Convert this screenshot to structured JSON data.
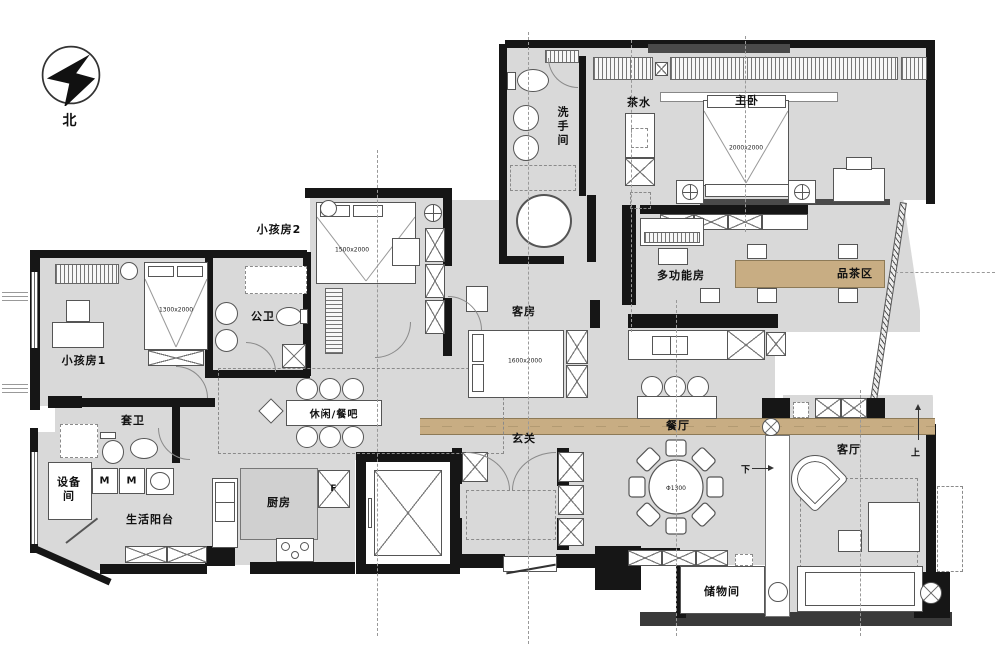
{
  "compass": {
    "north": "北"
  },
  "rooms": {
    "washroom": "洗手间",
    "tea": "茶水",
    "master": "主卧",
    "multi": "多功能房",
    "tea_area": "品茶区",
    "kids2": "小孩房2",
    "kids1": "小孩房1",
    "public_bath": "公卫",
    "guest": "客房",
    "bar": "休闲/餐吧",
    "ensuite": "套卫",
    "equipment": "设备间",
    "balcony": "生活阳台",
    "kitchen": "厨房",
    "entry": "玄关",
    "dining": "餐厅",
    "living": "客厅",
    "storage": "储物间"
  },
  "dims": {
    "master_bed": "2000x2000",
    "kids2_bed": "1500x2000",
    "kids1_bed": "1300x2000",
    "guest_bed": "1600x2000",
    "dining_table": "Φ1300"
  },
  "ann": {
    "up": "上",
    "down": "下",
    "fridge": "F",
    "washer": "M"
  },
  "colors": {
    "room_fill": "#d9d9d9",
    "wall": "#161616",
    "wood": "#c8ad83",
    "line": "#555555"
  }
}
